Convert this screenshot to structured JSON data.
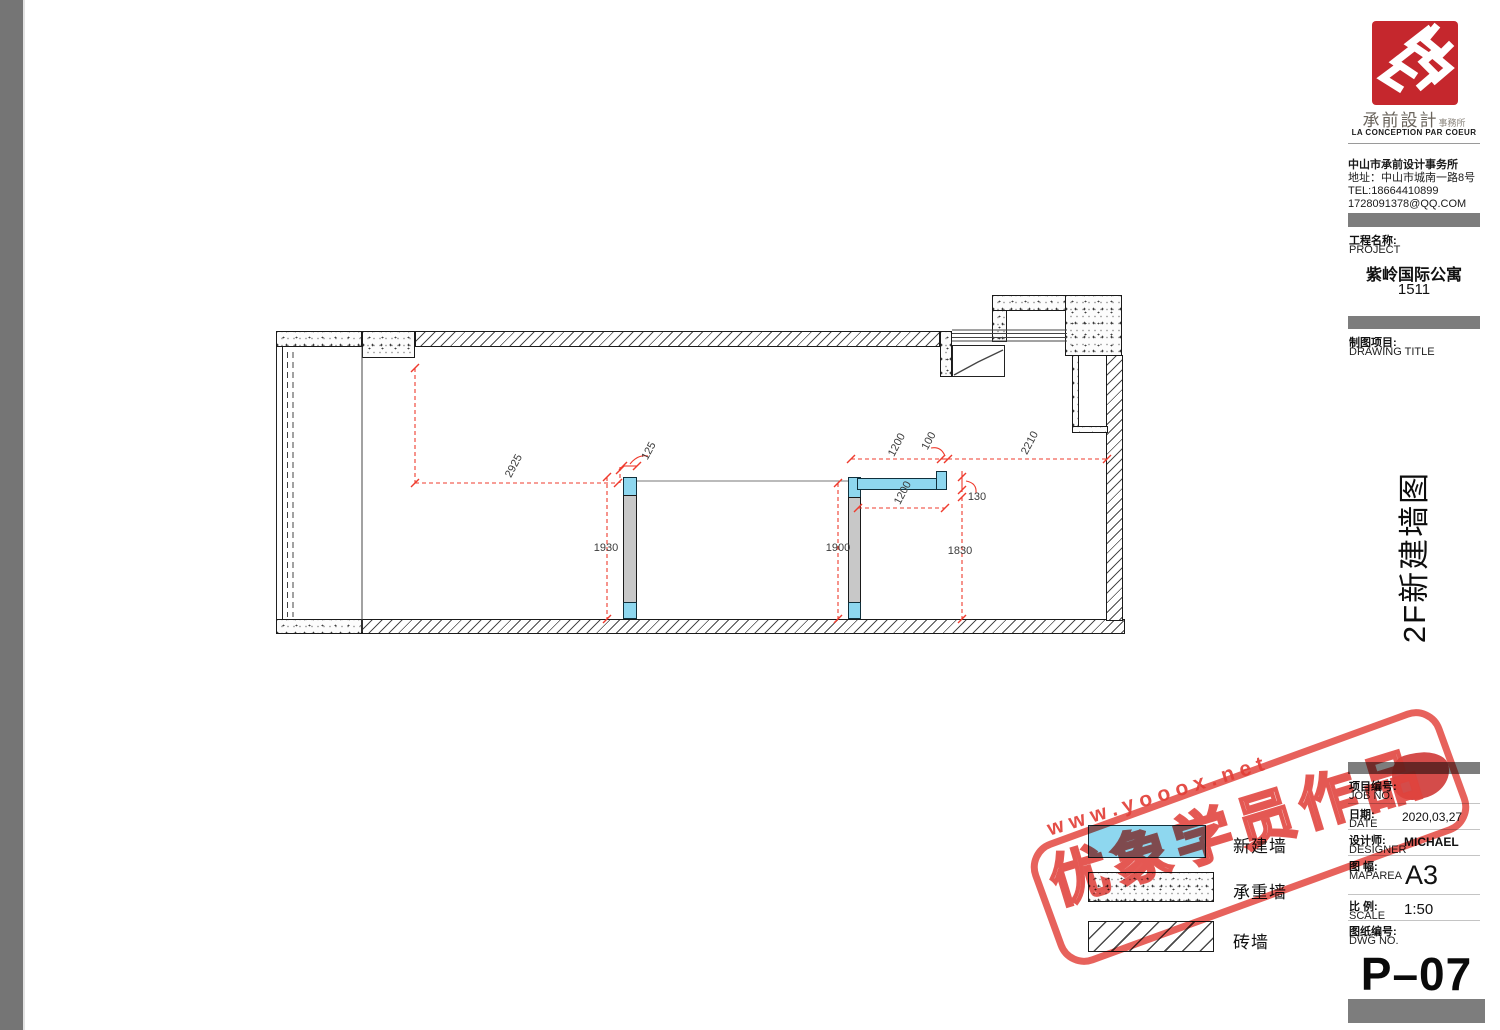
{
  "colors": {
    "accent_red": "#ef3b2d",
    "stamp_red": "#e0433e",
    "logo_red": "#c5272d",
    "new_wall_cyan": "#8ed7ef",
    "wall_gray": "#c8c8c8",
    "bar_gray": "#7d7d7d",
    "page_edge_gray": "#757575"
  },
  "logo": {
    "brand_cn": "承前設計",
    "brand_suffix": "事務所",
    "brand_en": "LA CONCEPTION PAR COEUR"
  },
  "contact": {
    "line1": "中山市承前设计事务所",
    "line2": "地址：中山市城南一路8号",
    "line3": "TEL:18664410899",
    "line4": "1728091378@QQ.COM"
  },
  "project": {
    "label_cn": "工程名称:",
    "label_en": "PROJECT",
    "name": "紫岭国际公寓",
    "number": "1511"
  },
  "drawing": {
    "label_cn": "制图项目:",
    "label_en": "DRAWING TITLE",
    "title_vertical": "2F新建墙图"
  },
  "titleblock": {
    "rows": [
      {
        "cn": "项目编号:",
        "en": "JOB NO.",
        "value": ""
      },
      {
        "cn": "日期:",
        "en": "DATE",
        "value": "2020,03,27"
      },
      {
        "cn": "设计师:",
        "en": "DESIGNER",
        "value": "MICHAEL"
      },
      {
        "cn": "图 幅:",
        "en": "MAPAREA",
        "value": "A3"
      },
      {
        "cn": "比 例:",
        "en": "SCALE",
        "value": "1:50"
      },
      {
        "cn": "图纸编号:",
        "en": "DWG NO.",
        "value": ""
      }
    ],
    "dwg_no": "P–07"
  },
  "legend": {
    "items": [
      {
        "label": "新建墙",
        "type": "new-wall"
      },
      {
        "label": "承重墙",
        "type": "load-bearing-wall"
      },
      {
        "label": "砖墙",
        "type": "brick-wall"
      }
    ]
  },
  "plan": {
    "dims": {
      "d2925": "2925",
      "d1930": "1930",
      "d125": "125",
      "d1900": "1900",
      "d1200a": "1200",
      "d100": "100",
      "d2210": "2210",
      "d130": "130",
      "d1200b": "1200",
      "d1830": "1830"
    }
  },
  "stamp": {
    "url": "www.yooox.net",
    "label": "优象学员作品"
  }
}
